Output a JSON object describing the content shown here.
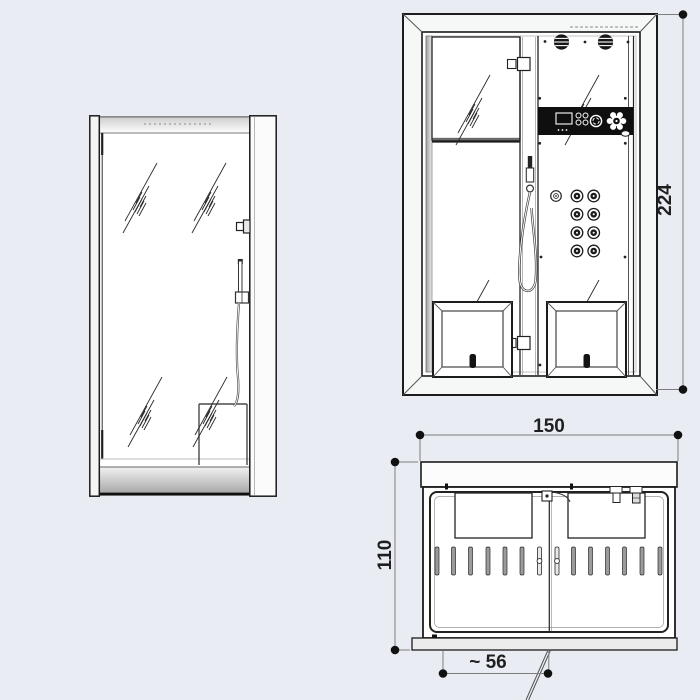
{
  "drawing": {
    "subject": "steam-shower-cabin technical drawing, three orthographic views",
    "views": [
      "side-elevation",
      "front-elevation",
      "top-plan"
    ]
  },
  "dimensions": {
    "front_height": {
      "value": "224"
    },
    "plan_width": {
      "value": "150"
    },
    "plan_depth": {
      "value": "110"
    },
    "plan_door_opening": {
      "value": "~ 56"
    }
  },
  "colors": {
    "background": "#e9edf3",
    "line": "#1c1c1c",
    "dimension_line": "#7d7d7d",
    "dimension_text": "#1f1f1f",
    "control_panel": "#0f0f0f",
    "slat_gray": "#9b9b9b",
    "tray_shadow": "#adadad"
  }
}
